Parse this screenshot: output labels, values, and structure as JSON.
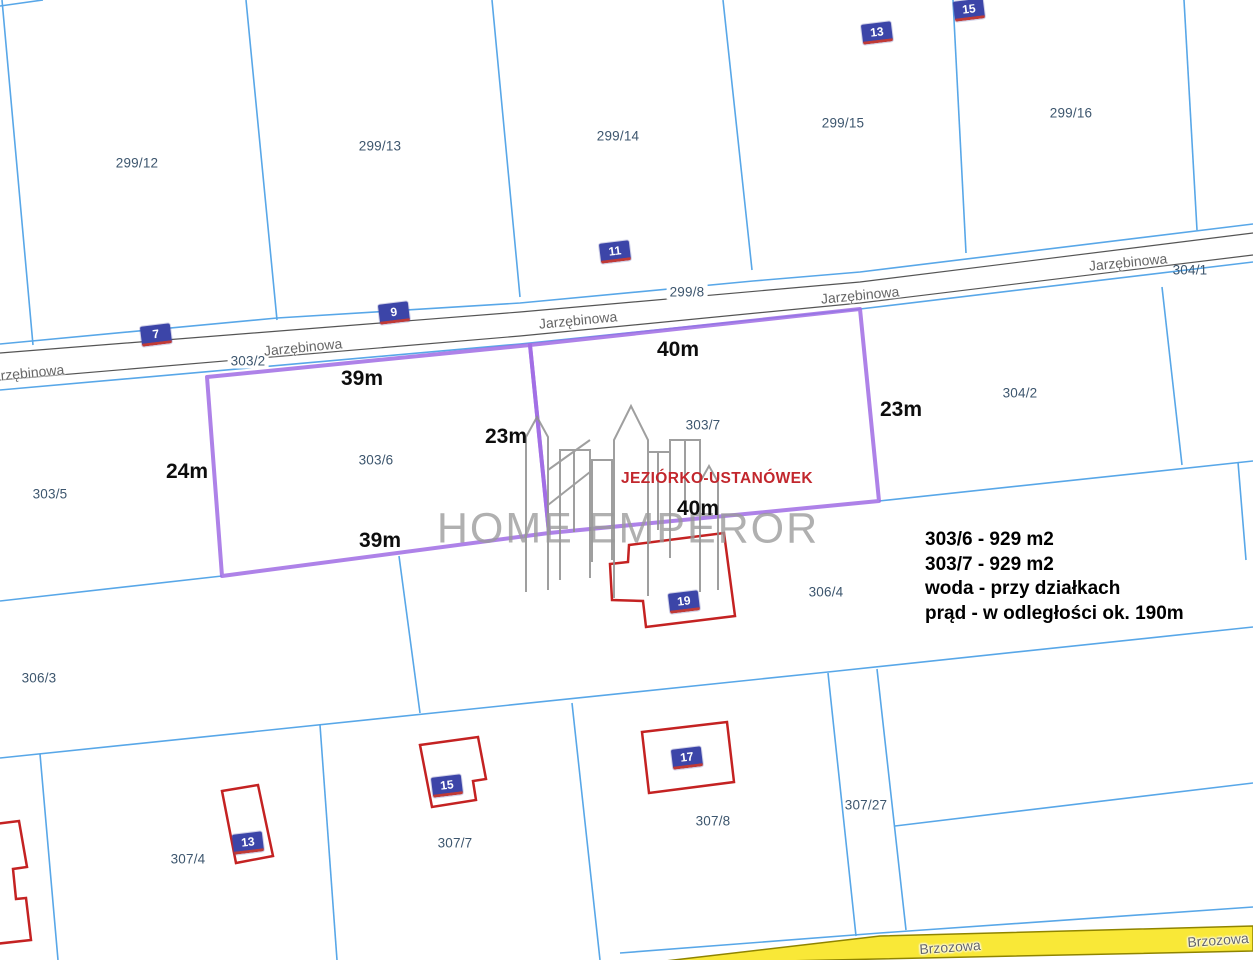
{
  "map_title": "cadastral-parcel-map",
  "colors": {
    "parcel_line": "#58A7E8",
    "road_line": "#555555",
    "highlight": "#A06CE4",
    "building": "#C42222",
    "badge_bg": "#3C45A8",
    "badge_accent": "#C03A36",
    "yellow_road_fill": "#F9E837",
    "yellow_road_border": "#8F8400",
    "parcel_label": "#3D566E",
    "dimension_label": "#0D0D0D",
    "street_label": "#666666",
    "watermark": "#9A9A9A",
    "location_label": "#C2272D"
  },
  "parcels": [
    {
      "label": "299/12",
      "x": 137,
      "y": 163
    },
    {
      "label": "299/13",
      "x": 380,
      "y": 146
    },
    {
      "label": "299/14",
      "x": 618,
      "y": 136
    },
    {
      "label": "299/15",
      "x": 843,
      "y": 123
    },
    {
      "label": "299/16",
      "x": 1071,
      "y": 113
    },
    {
      "label": "304/1",
      "x": 1190,
      "y": 270
    },
    {
      "label": "299/8",
      "x": 687,
      "y": 292,
      "bg": true
    },
    {
      "label": "303/2",
      "x": 248,
      "y": 361,
      "bg": true
    },
    {
      "label": "303/5",
      "x": 50,
      "y": 494
    },
    {
      "label": "303/6",
      "x": 376,
      "y": 460
    },
    {
      "label": "303/7",
      "x": 703,
      "y": 425
    },
    {
      "label": "304/2",
      "x": 1020,
      "y": 393
    },
    {
      "label": "306/3",
      "x": 39,
      "y": 678
    },
    {
      "label": "306/4",
      "x": 826,
      "y": 592
    },
    {
      "label": "307/4",
      "x": 188,
      "y": 859
    },
    {
      "label": "307/7",
      "x": 455,
      "y": 843
    },
    {
      "label": "307/8",
      "x": 713,
      "y": 821
    },
    {
      "label": "307/27",
      "x": 866,
      "y": 805
    }
  ],
  "streets": [
    {
      "name": "Jarzębinowa",
      "x": 25,
      "y": 373,
      "rot": -5.5
    },
    {
      "name": "Jarzębinowa",
      "x": 303,
      "y": 347,
      "rot": -5.5
    },
    {
      "name": "Jarzębinowa",
      "x": 578,
      "y": 320,
      "rot": -5.5
    },
    {
      "name": "Jarzębinowa",
      "x": 860,
      "y": 295,
      "rot": -5.5
    },
    {
      "name": "Jarzębinowa",
      "x": 1128,
      "y": 262,
      "rot": -5.5
    },
    {
      "name": "Brzozowa",
      "x": 950,
      "y": 947,
      "rot": -4
    },
    {
      "name": "Brzozowa",
      "x": 1218,
      "y": 940,
      "rot": -4
    }
  ],
  "dimensions": [
    {
      "label": "39m",
      "x": 362,
      "y": 379
    },
    {
      "label": "40m",
      "x": 678,
      "y": 350
    },
    {
      "label": "23m",
      "x": 901,
      "y": 410
    },
    {
      "label": "23m",
      "x": 506,
      "y": 437
    },
    {
      "label": "24m",
      "x": 187,
      "y": 472
    },
    {
      "label": "39m",
      "x": 380,
      "y": 541
    },
    {
      "label": "40m",
      "x": 698,
      "y": 509
    }
  ],
  "address_badges": [
    {
      "number": "7",
      "x": 156,
      "y": 336
    },
    {
      "number": "9",
      "x": 394,
      "y": 314
    },
    {
      "number": "11",
      "x": 615,
      "y": 253
    },
    {
      "number": "13",
      "x": 877,
      "y": 34
    },
    {
      "number": "15",
      "x": 969,
      "y": 11
    },
    {
      "number": "19",
      "x": 684,
      "y": 603
    },
    {
      "number": "17",
      "x": 687,
      "y": 759
    },
    {
      "number": "15",
      "x": 447,
      "y": 787
    },
    {
      "number": "13",
      "x": 248,
      "y": 844
    }
  ],
  "info_block": {
    "lines": [
      "303/6 - 929 m2",
      "303/7 - 929 m2",
      "woda - przy działkach",
      "prąd - w odległości ok. 190m"
    ]
  },
  "watermark": {
    "brand": "HOME EMPEROR",
    "location": "JEZIÓRKO-USTANÓWEK"
  }
}
